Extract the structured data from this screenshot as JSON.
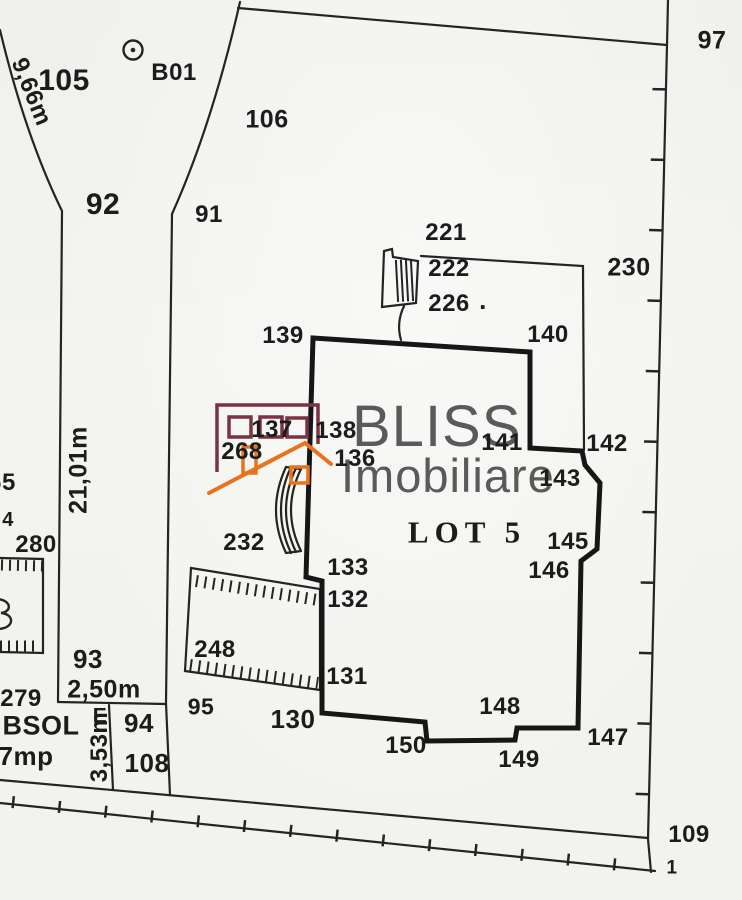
{
  "colors": {
    "ink": "#242424",
    "lot_outline": "#161616",
    "watermark_maroon": "#7b3342",
    "watermark_orange": "#e8731d",
    "watermark_text_gray": "#4d4d4d",
    "paper": "#f3f3f0"
  },
  "watermark": {
    "line1": "BLISS",
    "line2": "Imobiliare"
  },
  "plan": {
    "lot_label": "LOT 5",
    "points": [
      {
        "t": "105",
        "x": 64,
        "y": 81,
        "fs": 30
      },
      {
        "t": "B01",
        "x": 174,
        "y": 73,
        "fs": 24
      },
      {
        "t": "106",
        "x": 267,
        "y": 120,
        "fs": 25
      },
      {
        "t": "97",
        "x": 712,
        "y": 41,
        "fs": 25
      },
      {
        "t": "92",
        "x": 103,
        "y": 205,
        "fs": 30
      },
      {
        "t": "91",
        "x": 209,
        "y": 215,
        "fs": 24
      },
      {
        "t": "221",
        "x": 446,
        "y": 233,
        "fs": 24
      },
      {
        "t": "222",
        "x": 449,
        "y": 269,
        "fs": 24
      },
      {
        "t": "226",
        "x": 449,
        "y": 304,
        "fs": 24
      },
      {
        "t": ".",
        "x": 483,
        "y": 300,
        "fs": 26
      },
      {
        "t": "230",
        "x": 629,
        "y": 268,
        "fs": 25
      },
      {
        "t": "139",
        "x": 283,
        "y": 336,
        "fs": 24
      },
      {
        "t": "140",
        "x": 548,
        "y": 335,
        "fs": 24
      },
      {
        "t": "137",
        "x": 272,
        "y": 430,
        "fs": 24
      },
      {
        "t": "138",
        "x": 336,
        "y": 431,
        "fs": 24
      },
      {
        "t": "268",
        "x": 242,
        "y": 452,
        "fs": 24
      },
      {
        "t": "136",
        "x": 355,
        "y": 459,
        "fs": 24
      },
      {
        "t": "141",
        "x": 502,
        "y": 443,
        "fs": 24
      },
      {
        "t": "142",
        "x": 607,
        "y": 444,
        "fs": 24
      },
      {
        "t": "143",
        "x": 560,
        "y": 479,
        "fs": 24
      },
      {
        "t": "LOT 5",
        "x": 467,
        "y": 532,
        "fs": 31,
        "serif": true,
        "ls": 6
      },
      {
        "t": "145",
        "x": 568,
        "y": 542,
        "fs": 24
      },
      {
        "t": "146",
        "x": 549,
        "y": 571,
        "fs": 24
      },
      {
        "t": "232",
        "x": 244,
        "y": 543,
        "fs": 24
      },
      {
        "t": "133",
        "x": 348,
        "y": 568,
        "fs": 24
      },
      {
        "t": "132",
        "x": 348,
        "y": 600,
        "fs": 24
      },
      {
        "t": "248",
        "x": 215,
        "y": 650,
        "fs": 24
      },
      {
        "t": "131",
        "x": 347,
        "y": 677,
        "fs": 24
      },
      {
        "t": "93",
        "x": 88,
        "y": 659,
        "fs": 26
      },
      {
        "t": "2,50m",
        "x": 104,
        "y": 690,
        "fs": 25
      },
      {
        "t": "95",
        "x": 201,
        "y": 707,
        "fs": 23
      },
      {
        "t": "130",
        "x": 293,
        "y": 719,
        "fs": 26
      },
      {
        "t": "94",
        "x": 139,
        "y": 723,
        "fs": 26
      },
      {
        "t": "150",
        "x": 406,
        "y": 746,
        "fs": 24
      },
      {
        "t": "148",
        "x": 500,
        "y": 707,
        "fs": 24
      },
      {
        "t": "149",
        "x": 519,
        "y": 760,
        "fs": 24
      },
      {
        "t": "147",
        "x": 608,
        "y": 738,
        "fs": 24
      },
      {
        "t": "108",
        "x": 147,
        "y": 763,
        "fs": 26
      },
      {
        "t": "109",
        "x": 689,
        "y": 835,
        "fs": 24
      },
      {
        "t": "1",
        "x": 672,
        "y": 868,
        "fs": 19
      },
      {
        "t": "280",
        "x": 36,
        "y": 545,
        "fs": 24
      },
      {
        "t": "279",
        "x": 21,
        "y": 699,
        "fs": 24
      },
      {
        "t": "65",
        "x": 2,
        "y": 483,
        "fs": 24
      },
      {
        "t": "4",
        "x": 8,
        "y": 520,
        "fs": 20
      },
      {
        "t": "BSOL",
        "x": 41,
        "y": 726,
        "fs": 27
      },
      {
        "t": "E",
        "x": 100,
        "y": 716,
        "fs": 21
      },
      {
        "t": "7mp",
        "x": 26,
        "y": 756,
        "fs": 26
      },
      {
        "t": "9,66m",
        "x": 31,
        "y": 92,
        "fs": 24,
        "r": 68
      },
      {
        "t": "21,01m",
        "x": 79,
        "y": 470,
        "fs": 25,
        "r": -90
      },
      {
        "t": "3,53m",
        "x": 100,
        "y": 747,
        "fs": 24,
        "r": -90
      }
    ]
  }
}
